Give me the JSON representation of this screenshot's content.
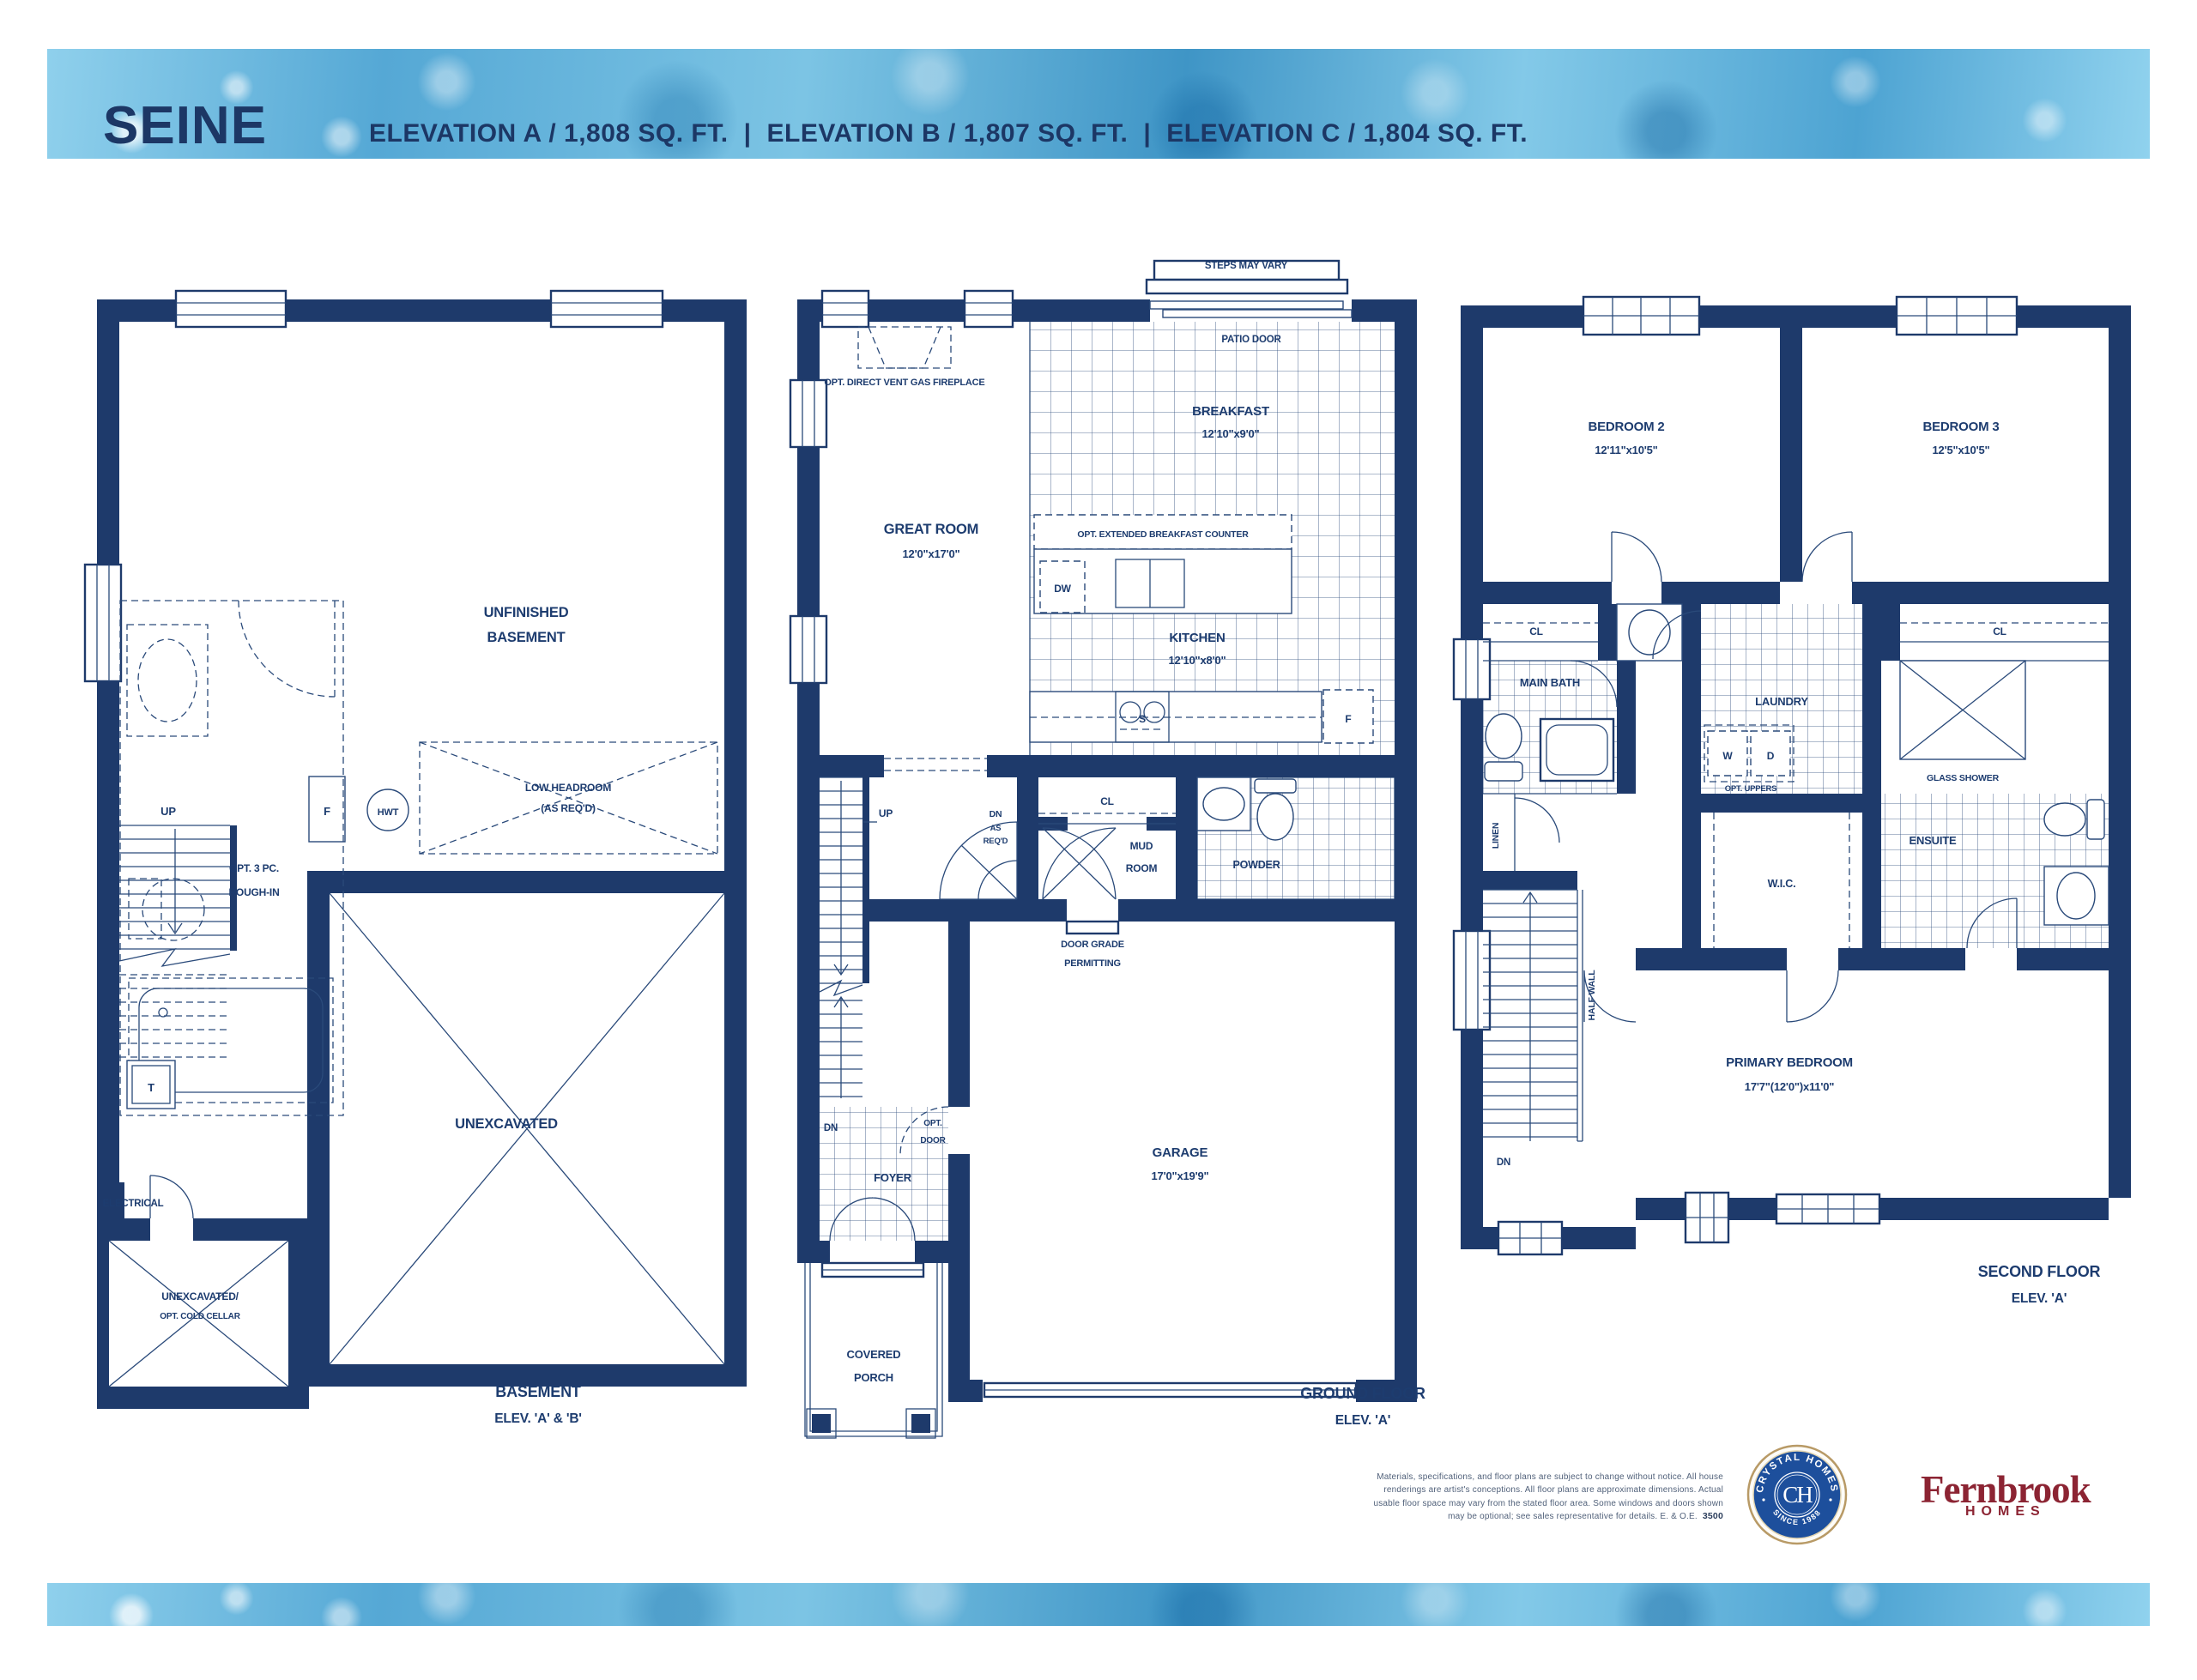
{
  "header": {
    "title": "SEINE",
    "elevations": [
      "ELEVATION A / 1,808 SQ. FT.",
      "ELEVATION B / 1,807 SQ. FT.",
      "ELEVATION C / 1,804 SQ. FT."
    ],
    "separator": "|"
  },
  "plans": {
    "basement": {
      "caption": [
        "BASEMENT",
        "ELEV. 'A' & 'B'"
      ],
      "unfinished": [
        "UNFINISHED",
        "BASEMENT"
      ],
      "rough_in": [
        "OPT. 3 PC.",
        "ROUGH-IN"
      ],
      "up": "UP",
      "furnace": "F",
      "hwt": "HWT",
      "tank": "T",
      "low_headroom": [
        "LOW HEADROOM",
        "(AS REQ'D)"
      ],
      "unexcavated": "UNEXCAVATED",
      "electrical": "ELECTRICAL",
      "cold_cellar": [
        "UNEXCAVATED/",
        "OPT. COLD CELLAR"
      ]
    },
    "ground": {
      "caption": [
        "GROUND FLOOR",
        "ELEV. 'A'"
      ],
      "steps_may_vary": "STEPS MAY VARY",
      "patio_door": "PATIO DOOR",
      "fireplace": "OPT. DIRECT VENT GAS FIREPLACE",
      "great_room": [
        "GREAT ROOM",
        "12'0\"x17'0\""
      ],
      "breakfast": [
        "BREAKFAST",
        "12'10\"x9'0\""
      ],
      "breakfast_counter": "OPT. EXTENDED BREAKFAST COUNTER",
      "dw": "DW",
      "kitchen": [
        "KITCHEN",
        "12'10\"x8'0\""
      ],
      "sink": "S",
      "fridge": "F",
      "closet": "CL",
      "up": "UP",
      "dn_as_reqd": [
        "DN",
        "AS",
        "REQ'D"
      ],
      "mud_room": [
        "MUD",
        "ROOM"
      ],
      "powder": "POWDER",
      "door_grade": [
        "DOOR GRADE",
        "PERMITTING"
      ],
      "opt_door": [
        "OPT.",
        "DOOR"
      ],
      "dn": "DN",
      "foyer": "FOYER",
      "garage": [
        "GARAGE",
        "17'0\"x19'9\""
      ],
      "covered_porch": [
        "COVERED",
        "PORCH"
      ]
    },
    "second": {
      "caption": [
        "SECOND FLOOR",
        "ELEV. 'A'"
      ],
      "bedroom2": [
        "BEDROOM 2",
        "12'11\"x10'5\""
      ],
      "bedroom3": [
        "BEDROOM 3",
        "12'5\"x10'5\""
      ],
      "cl_left": "CL",
      "cl_right": "CL",
      "main_bath": "MAIN BATH",
      "linen": "LINEN",
      "laundry": "LAUNDRY",
      "washer": "W",
      "dryer": "D",
      "opt_uppers": "OPT. UPPERS",
      "glass_shower": "GLASS SHOWER",
      "ensuite": "ENSUITE",
      "wic": "W.I.C.",
      "half_wall": "HALF WALL",
      "dn": "DN",
      "primary": [
        "PRIMARY BEDROOM",
        "17'7\"(12'0\")x11'0\""
      ]
    }
  },
  "footer": {
    "disclaimer": [
      "Materials, specifications, and floor plans are subject to change without notice. All house",
      "renderings are artist's conceptions. All floor plans are approximate dimensions. Actual",
      "usable floor space may vary from the stated floor area. Some windows and doors shown",
      "may be optional; see sales representative for details. E. & O.E."
    ],
    "code": "3500",
    "crystal": {
      "arc_top": "CRYSTAL HOMES",
      "arc_bottom": "SINCE 1988",
      "monogram": "CH"
    },
    "fernbrook": {
      "name": "Fernbrook",
      "sub": "HOMES"
    }
  }
}
